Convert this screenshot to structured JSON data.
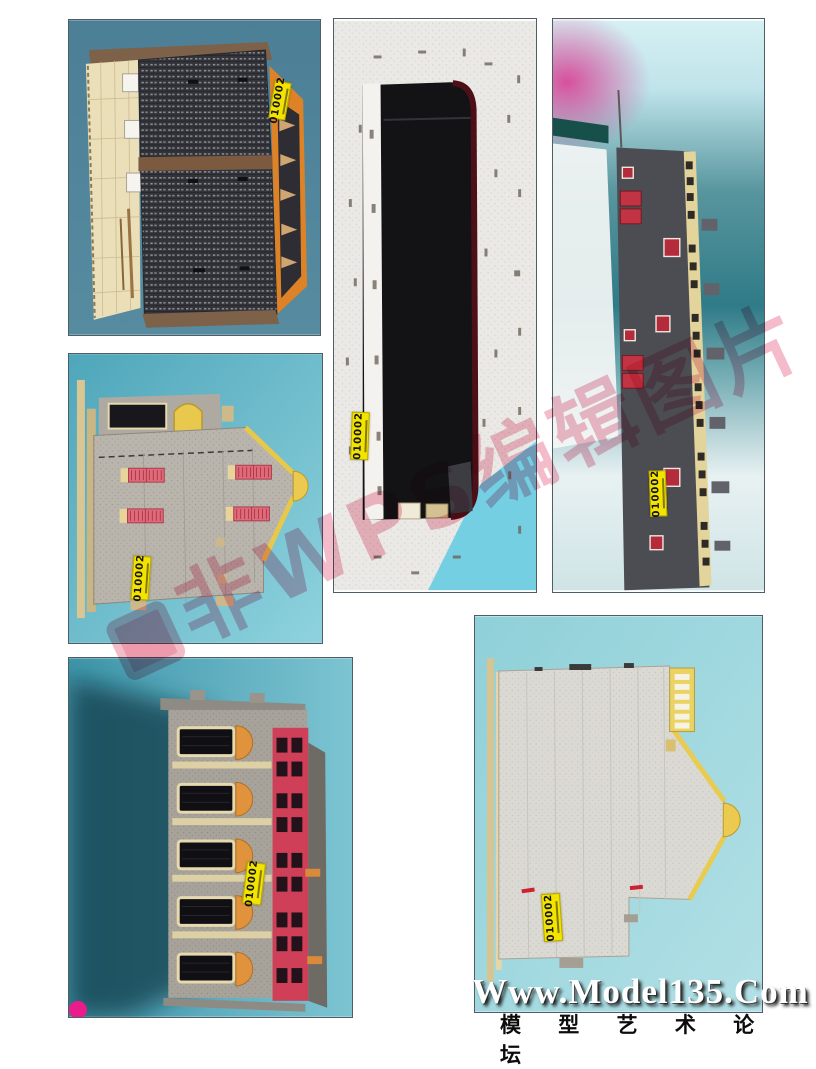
{
  "footer": {
    "site": "Www.Model135.Com",
    "forum": "模 型 艺 术 论 坛"
  },
  "watermark": {
    "text": "非WPS编辑图片",
    "color": "#de3460"
  },
  "sticker": {
    "code": "010002",
    "color": "#f2e300"
  },
  "palette": {
    "photo_bg_teal": "#4d8399",
    "photo_bg_teal_light": "#57b0c2",
    "photo_bg_cyan_pale": "#9ad4dc",
    "photo_bg_sheet": "#eae9e5",
    "roof_dark": "#33343a",
    "wall_gray": "#b9b5ad",
    "panel_cream": "#eadfb8",
    "accent_orange": "#dd8226",
    "accent_yellow": "#ecc94f",
    "shutter_pink": "#e06a77",
    "door_red": "#c23343",
    "red_wall": "#cf4058",
    "magenta_blob": "#ea1c8c"
  }
}
